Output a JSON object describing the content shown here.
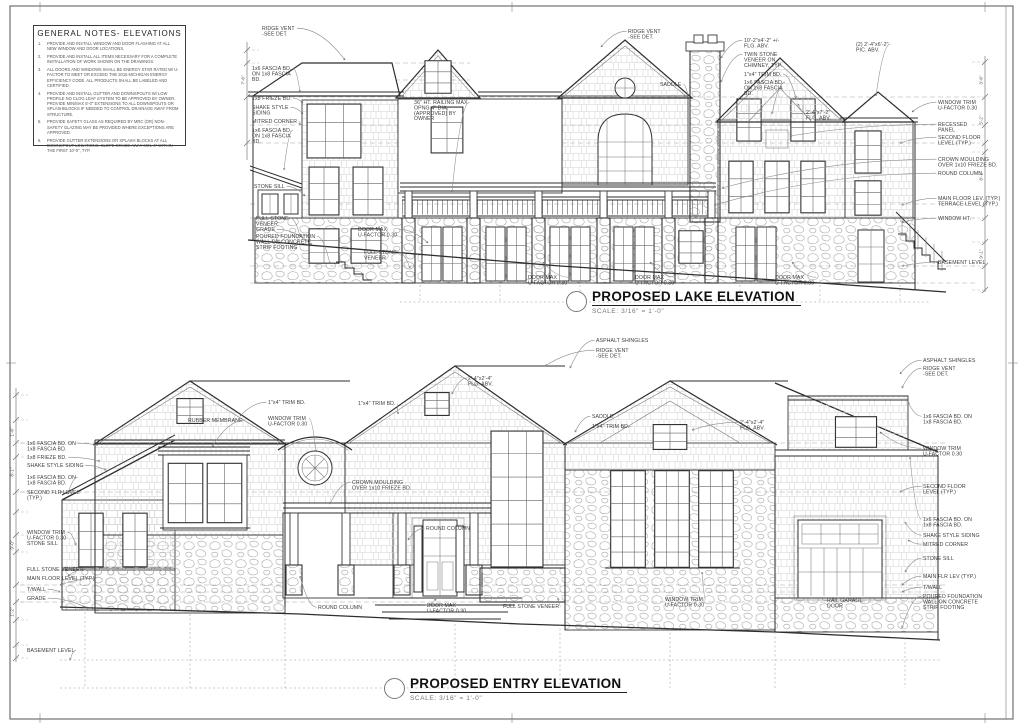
{
  "general_notes": {
    "title": "GENERAL NOTES- ELEVATIONS",
    "notes": [
      {
        "num": "1.",
        "text": "PROVIDE AND INSTALL WINDOW AND DOOR FLASHING AT ALL NEW WINDOW AND DOOR LOCATIONS."
      },
      {
        "num": "2.",
        "text": "PROVIDE AND INSTALL ALL ITEMS NECESSARY FOR A COMPLETE INSTALLATION OF WORK SHOWN ON THE DRAWINGS."
      },
      {
        "num": "3.",
        "text": "ALL DOORS AND WINDOWS SHALL BE ENERGY STAR RATED W/ U-FACTOR TO MEET OR EXCEED THE 2015 MICHIGAN ENERGY EFFICIENCY CODE.  ALL PRODUCTS SHALL BE LABELED AND CERTIFIED."
      },
      {
        "num": "4.",
        "text": "PROVIDE AND INSTALL GUTTER AND DOWNSPOUTS W/ LOW PROFILE NO CLOG LEAF SYSTEM TO BE APPROVED BY OWNER.  PROVIDE MIN/MAX 5'-0\" EXTENSIONS TO ALL DOWNSPOUTS OR SPLASHBLOCKS IF NEEDED TO CONTROL DRAINAGE AWAY FROM STRUCTURE."
      },
      {
        "num": "5.",
        "text": "PROVIDE SAFETY GLASS AS REQUIRED BY MRC (OR) NON-SAFETY GLAZING MAY BE PROVIDED WHERE EXCEPTIONS ARE APPROVED."
      },
      {
        "num": "6.",
        "text": "PROVIDE GUTTER EXTENSIONS OR SPLASH BLOCKS AT ALL DOWNSPOUT LOCATIONS. SLOPE GRADE AWAY MIN. 6\" WITHIN THE FIRST 10'-0\", TYP."
      }
    ]
  },
  "drawings": {
    "lake": {
      "title": "PROPOSED LAKE ELEVATION",
      "scale": "SCALE: 3/16\" = 1'-0\""
    },
    "entry": {
      "title": "PROPOSED ENTRY ELEVATION",
      "scale": "SCALE: 3/16\" = 1'-0\""
    }
  },
  "annotations": {
    "lake": [
      {
        "l": [
          "RIDGE VENT",
          "-SEE DET."
        ],
        "x": 262,
        "y": 30,
        "s": "L",
        "tx": 345,
        "ty": 60
      },
      {
        "l": [
          "RIDGE VENT",
          "-SEE DET."
        ],
        "x": 628,
        "y": 33,
        "s": "R",
        "tx": 601,
        "ty": 47
      },
      {
        "l": [
          "1x6 FASCIA BD.",
          "ON 1x8 FASCIA",
          "BD."
        ],
        "x": 252,
        "y": 70,
        "s": "L",
        "tx": 300,
        "ty": 92
      },
      {
        "l": [
          "1x8 FRIEZE BD."
        ],
        "x": 252,
        "y": 100,
        "s": "L",
        "tx": 303,
        "ty": 103
      },
      {
        "l": [
          "SHAKE STYLE",
          "SIDING"
        ],
        "x": 252,
        "y": 109,
        "s": "L",
        "tx": 303,
        "ty": 114
      },
      {
        "l": [
          "MITRED CORNER"
        ],
        "x": 252,
        "y": 123,
        "s": "L",
        "tx": 300,
        "ty": 125
      },
      {
        "l": [
          "1x6 FASCIA BD.",
          "ON 1x8 FASCIA",
          "BD."
        ],
        "x": 252,
        "y": 132,
        "s": "L",
        "tx": 284,
        "ty": 170
      },
      {
        "l": [
          "STONE SILL"
        ],
        "x": 254,
        "y": 188,
        "s": "L",
        "tx": 305,
        "ty": 196
      },
      {
        "l": [
          "FULL STONE",
          "VENEER"
        ],
        "x": 256,
        "y": 220,
        "s": "L",
        "tx": 300,
        "ty": 236
      },
      {
        "l": [
          "GRADE"
        ],
        "x": 256,
        "y": 231,
        "s": "L",
        "tx": 312,
        "ty": 245
      },
      {
        "l": [
          "POURED FOUNDATION",
          "WALL ON CONCRETE",
          "STRIP FOOTING"
        ],
        "x": 256,
        "y": 238,
        "s": "L",
        "tx": 330,
        "ty": 264
      },
      {
        "l": [
          "DOOR MAX",
          "U-FACTOR 0.30"
        ],
        "x": 358,
        "y": 231,
        "s": "L",
        "tx": 428,
        "ty": 243
      },
      {
        "l": [
          "FULL STONE",
          "VENEER"
        ],
        "x": 364,
        "y": 254,
        "s": "L",
        "tx": 410,
        "ty": 268
      },
      {
        "l": [
          "36\" HT. RAILING MAX",
          "OPNG 4\" DIA.",
          "(APPROVED) BY",
          "OWNER"
        ],
        "x": 414,
        "y": 104,
        "s": "L",
        "tx": 452,
        "ty": 192
      },
      {
        "l": [
          "10'-2\"x4'-2\" +/-",
          "FLG. ABV."
        ],
        "x": 744,
        "y": 42,
        "s": "R",
        "tx": 721,
        "ty": 58
      },
      {
        "l": [
          "TWIN STONE",
          "VENEER ON",
          "CHIMNEY, TYP."
        ],
        "x": 744,
        "y": 56,
        "s": "R",
        "tx": 721,
        "ty": 82
      },
      {
        "l": [
          "1\"x4\" TRIM BD."
        ],
        "x": 744,
        "y": 76,
        "s": "L",
        "tx": 796,
        "ty": 98
      },
      {
        "l": [
          "1x6 FASCIA BD.",
          "ON 1x8 FASCIA",
          "BD."
        ],
        "x": 744,
        "y": 84,
        "s": "L",
        "tx": 772,
        "ty": 114
      },
      {
        "l": [
          "SADDLE"
        ],
        "x": 660,
        "y": 86,
        "s": "L",
        "tx": 688,
        "ty": 96
      },
      {
        "l": [
          "2'-4\"x7'-2\"",
          "FLG. ABV."
        ],
        "x": 806,
        "y": 114,
        "s": "R",
        "tx": 798,
        "ty": 104
      },
      {
        "l": [
          "(2) 2'-4\"x6'-2\"",
          "PIC. ABV."
        ],
        "x": 856,
        "y": 46,
        "s": "L",
        "tx": 876,
        "ty": 96
      },
      {
        "l": [
          "WINDOW TRIM",
          "U-FACTOR 0.30"
        ],
        "x": 938,
        "y": 104,
        "s": "R",
        "tx": 912,
        "ty": 112
      },
      {
        "l": [
          "RECESSED",
          "PANEL"
        ],
        "x": 938,
        "y": 126,
        "s": "R",
        "tx": 790,
        "ty": 136
      },
      {
        "l": [
          "SECOND FLOOR",
          "LEVEL (TYP.)"
        ],
        "x": 938,
        "y": 139,
        "s": "R",
        "tx": 900,
        "ty": 143
      },
      {
        "l": [
          "CROWN MOULDING",
          "OVER 1x10 FRIEZE BD."
        ],
        "x": 938,
        "y": 161,
        "s": "R",
        "tx": 722,
        "ty": 188
      },
      {
        "l": [
          "ROUND COLUMN"
        ],
        "x": 938,
        "y": 175,
        "s": "R",
        "tx": 714,
        "ty": 205
      },
      {
        "l": [
          "MAIN FLOOR LEV. (TYP.)",
          "TERRACE LEVEL (TYP.)"
        ],
        "x": 938,
        "y": 200,
        "s": "R",
        "tx": 902,
        "ty": 205
      },
      {
        "l": [
          "WINDOW HT."
        ],
        "x": 938,
        "y": 220,
        "s": "R",
        "tx": 902,
        "ty": 222
      },
      {
        "l": [
          "BASEMENT LEVEL"
        ],
        "x": 938,
        "y": 264,
        "s": "R",
        "tx": 902,
        "ty": 266
      },
      {
        "l": [
          "DOOR MAX",
          "U-FACTOR 0.30"
        ],
        "x": 528,
        "y": 279,
        "s": "L",
        "tx": 543,
        "ty": 262
      },
      {
        "l": [
          "DOOR MAX",
          "U-FACTOR 0.30"
        ],
        "x": 635,
        "y": 279,
        "s": "L",
        "tx": 650,
        "ty": 262
      },
      {
        "l": [
          "DOOR MAX",
          "U-FACTOR 0.30"
        ],
        "x": 775,
        "y": 279,
        "s": "L",
        "tx": 792,
        "ty": 262
      }
    ],
    "entry": [
      {
        "l": [
          "1x6 FASCIA BD. ON",
          "1x8 FASCIA BD."
        ],
        "x": 27,
        "y": 445,
        "s": "L",
        "tx": 98,
        "ty": 445
      },
      {
        "l": [
          "1x8 FRIEZE BD."
        ],
        "x": 27,
        "y": 459,
        "s": "L",
        "tx": 100,
        "ty": 461
      },
      {
        "l": [
          "SHAKE STYLE SIDING"
        ],
        "x": 27,
        "y": 467,
        "s": "L",
        "tx": 106,
        "ty": 470
      },
      {
        "l": [
          "1x6 FASCIA BD. ON",
          "1x8 FASCIA BD."
        ],
        "x": 27,
        "y": 479,
        "s": "L",
        "tx": 68,
        "ty": 494
      },
      {
        "l": [
          "SECOND FLR LEVEL",
          "(TYP.)"
        ],
        "x": 27,
        "y": 494,
        "s": "L",
        "tx": 60,
        "ty": 492
      },
      {
        "l": [
          "WINDOW TRIM",
          "U-FACTOR 0.30",
          "STONE SILL"
        ],
        "x": 27,
        "y": 534,
        "s": "L",
        "tx": 76,
        "ty": 545
      },
      {
        "l": [
          "FULL STONE VENEER"
        ],
        "x": 27,
        "y": 571,
        "s": "L",
        "tx": 68,
        "ty": 576
      },
      {
        "l": [
          "MAIN FLOOR LEVEL (TYP.)"
        ],
        "x": 27,
        "y": 580,
        "s": "L",
        "tx": 60,
        "ty": 585
      },
      {
        "l": [
          "T/WALL"
        ],
        "x": 27,
        "y": 591,
        "s": "L",
        "tx": 60,
        "ty": 592
      },
      {
        "l": [
          "GRADE"
        ],
        "x": 27,
        "y": 600,
        "s": "L",
        "tx": 85,
        "ty": 607
      },
      {
        "l": [
          "BASEMENT LEVEL"
        ],
        "x": 27,
        "y": 652,
        "s": "L",
        "tx": 70,
        "ty": 660
      },
      {
        "l": [
          "ASPHALT SHINGLES"
        ],
        "x": 596,
        "y": 342,
        "s": "R",
        "tx": 570,
        "ty": 368
      },
      {
        "l": [
          "RIDGE VENT",
          "-SEE DET."
        ],
        "x": 596,
        "y": 352,
        "s": "R",
        "tx": 545,
        "ty": 366
      },
      {
        "l": [
          "SADDLE"
        ],
        "x": 592,
        "y": 418,
        "s": "R",
        "tx": 575,
        "ty": 432
      },
      {
        "l": [
          "1\"x4\" TRIM BD."
        ],
        "x": 592,
        "y": 428,
        "s": "L",
        "tx": 622,
        "ty": 428
      },
      {
        "l": [
          "2'-4\"x2'-4\"",
          "FLG. ABV."
        ],
        "x": 468,
        "y": 380,
        "s": "R",
        "tx": 452,
        "ty": 394
      },
      {
        "l": [
          "2'-4\"x2'-4\"",
          "FLG. ABV."
        ],
        "x": 740,
        "y": 424,
        "s": "R",
        "tx": 692,
        "ty": 430
      },
      {
        "l": [
          "1\"x4\" TRIM BD."
        ],
        "x": 358,
        "y": 405,
        "s": "L",
        "tx": 398,
        "ty": 414
      },
      {
        "l": [
          "1\"x4\" TRIM BD."
        ],
        "x": 268,
        "y": 404,
        "s": "R",
        "tx": 240,
        "ty": 416
      },
      {
        "l": [
          "WINDOW TRIM",
          "U-FACTOR 0.30"
        ],
        "x": 268,
        "y": 420,
        "s": "L",
        "tx": 316,
        "ty": 452
      },
      {
        "l": [
          "RUBBER MEMBRANE"
        ],
        "x": 188,
        "y": 422,
        "s": "L",
        "tx": 212,
        "ty": 447
      },
      {
        "l": [
          "ASPHALT SHINGLES"
        ],
        "x": 923,
        "y": 362,
        "s": "R",
        "tx": 900,
        "ty": 374
      },
      {
        "l": [
          "RIDGE VENT",
          "-SEE DET."
        ],
        "x": 923,
        "y": 370,
        "s": "R",
        "tx": 902,
        "ty": 388
      },
      {
        "l": [
          "1x6 FASCIA BD. ON",
          "1x8 FASCIA BD."
        ],
        "x": 923,
        "y": 418,
        "s": "R",
        "tx": 908,
        "ty": 402
      },
      {
        "l": [
          "WINDOW TRIM",
          "U-FACTOR 0.30"
        ],
        "x": 923,
        "y": 450,
        "s": "R",
        "tx": 880,
        "ty": 432
      },
      {
        "l": [
          "SECOND FLOOR",
          "LEVEL (TYP.)"
        ],
        "x": 923,
        "y": 488,
        "s": "R",
        "tx": 900,
        "ty": 492
      },
      {
        "l": [
          "1x6 FASCIA BD. ON",
          "1x8 FASCIA BD."
        ],
        "x": 923,
        "y": 521,
        "s": "R",
        "tx": 910,
        "ty": 457
      },
      {
        "l": [
          "SHAKE STYLE SIDING"
        ],
        "x": 923,
        "y": 537,
        "s": "R",
        "tx": 905,
        "ty": 522
      },
      {
        "l": [
          "MITRED CORNER"
        ],
        "x": 923,
        "y": 546,
        "s": "R",
        "tx": 908,
        "ty": 540
      },
      {
        "l": [
          "STONE SILL"
        ],
        "x": 923,
        "y": 560,
        "s": "R",
        "tx": 905,
        "ty": 572
      },
      {
        "l": [
          "MAIN FLR LEV (TYP.)"
        ],
        "x": 923,
        "y": 578,
        "s": "R",
        "tx": 902,
        "ty": 585
      },
      {
        "l": [
          "T/WALL"
        ],
        "x": 923,
        "y": 589,
        "s": "R",
        "tx": 902,
        "ty": 592
      },
      {
        "l": [
          "POURED FOUNDATION",
          "WALL ON CONCRETE",
          "STRIP FOOTING"
        ],
        "x": 923,
        "y": 598,
        "s": "R",
        "tx": 902,
        "ty": 628
      },
      {
        "l": [
          "FULL STONE VENEER"
        ],
        "x": 503,
        "y": 608,
        "s": "L",
        "tx": 558,
        "ty": 598
      },
      {
        "l": [
          "ROUND COLUMN"
        ],
        "x": 318,
        "y": 609,
        "s": "R",
        "tx": 300,
        "ty": 576
      },
      {
        "l": [
          "DOOR MAX",
          "U-FACTOR 0.30"
        ],
        "x": 427,
        "y": 607,
        "s": "R",
        "tx": 436,
        "ty": 599
      },
      {
        "l": [
          "WINDOW TRIM",
          "U-FACTOR 0.30"
        ],
        "x": 665,
        "y": 601,
        "s": "L",
        "tx": 702,
        "ty": 572
      },
      {
        "l": [
          "RAIL GARAGE",
          "DOOR"
        ],
        "x": 827,
        "y": 602,
        "s": "L",
        "tx": 845,
        "ty": 598
      },
      {
        "l": [
          "CROWN MOULDING",
          "OVER 1x10 FRIEZE BD."
        ],
        "x": 352,
        "y": 484,
        "s": "R",
        "tx": 330,
        "ty": 504
      },
      {
        "l": [
          "ROUND COLUMN"
        ],
        "x": 426,
        "y": 530,
        "s": "R",
        "tx": 408,
        "ty": 540
      }
    ]
  },
  "dimensions": [
    {
      "name": "lake-right-dim",
      "x": 985,
      "y1": 56,
      "y2": 292,
      "ext": -14,
      "ticks": [
        62,
        97,
        125,
        143,
        152,
        204,
        218,
        242,
        266,
        290
      ],
      "labels": [
        {
          "y": 80,
          "text": "3'-6\""
        },
        {
          "y": 120,
          "text": "5'-2\""
        },
        {
          "y": 176,
          "text": "8'-1\""
        },
        {
          "y": 254,
          "text": "9'-1\""
        }
      ]
    },
    {
      "name": "lake-left-dim",
      "x": 247,
      "y1": 42,
      "y2": 160,
      "ext": 12,
      "ticks": [
        50,
        63,
        97,
        143
      ],
      "labels": [
        {
          "y": 80,
          "text": "7'-6\""
        }
      ]
    },
    {
      "name": "entry-left-dim",
      "x": 16,
      "y1": 388,
      "y2": 662,
      "ext": 12,
      "ticks": [
        395,
        420,
        443,
        457,
        492,
        512,
        535,
        552,
        585,
        602,
        620,
        645,
        658
      ],
      "labels": [
        {
          "y": 432,
          "text": "1'-6\""
        },
        {
          "y": 472,
          "text": "8'-1\""
        },
        {
          "y": 545,
          "text": "9'-0\""
        },
        {
          "y": 612,
          "text": "1'-2\""
        }
      ]
    }
  ]
}
